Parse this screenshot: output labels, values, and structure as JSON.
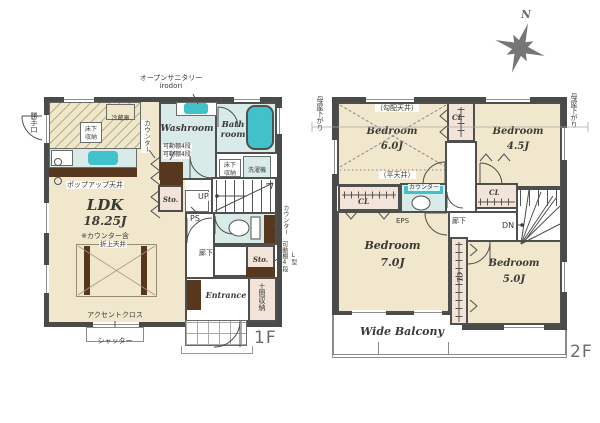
{
  "compass": {
    "north_label": "N"
  },
  "floor1": {
    "floor_label": "1F",
    "callout": {
      "open_sanitary": "オープンサニタリー",
      "brand": "irodori"
    },
    "kitchen": {
      "back_door": "勝手口",
      "fridge": "冷蔵庫",
      "floor_storage": "床下収納",
      "popup_ceiling": "ポップアップ天井"
    },
    "sanitary": {
      "washroom": "Washroom",
      "shelf": "可動棚4段",
      "bath_line1": "Bath",
      "bath_line2": "room",
      "floor_storage": "床下収納",
      "washer": "洗濯機"
    },
    "ldk": {
      "name": "LDK",
      "size": "18.25J",
      "note": "※カウンター含",
      "coffered_ceiling": "折上天井",
      "accent_cloth": "アクセントクロス",
      "shutter": "シャッター"
    },
    "core": {
      "counter": "カウンター",
      "shelf": "可動棚4段",
      "storage": "Sto.",
      "pipe_space": "PS",
      "stairs_up": "UP"
    },
    "hall": {
      "label": "廊下",
      "toilet_counter": "カウンター",
      "storage": "Sto.",
      "l_shape": "L型",
      "shelf": "可動棚4段"
    },
    "entrance": {
      "label": "Entrance",
      "doma_storage": "土間収納"
    }
  },
  "floor2": {
    "floor_label": "2F",
    "eaves_left": "母屋下がり",
    "eaves_right": "母屋下がり",
    "bedroom6": {
      "name": "Bedroom",
      "size": "6.0J",
      "sloped_ceiling": "（勾配天井）",
      "flat_ceiling": "（平天井）"
    },
    "bedroom45": {
      "name": "Bedroom",
      "size": "4.5J"
    },
    "bedroom7": {
      "name": "Bedroom",
      "size": "7.0J"
    },
    "bedroom5": {
      "name": "Bedroom",
      "size": "5.0J"
    },
    "closets": {
      "cl_top": "CL",
      "cl_left": "CL",
      "cl_mid": "CL",
      "cl_vert": "CL",
      "storage": "Sto."
    },
    "hall": {
      "label": "廊下",
      "down": "DN",
      "eps": "EPS",
      "toilet_counter": "カウンター"
    },
    "balcony": {
      "label": "Wide Balcony"
    }
  }
}
